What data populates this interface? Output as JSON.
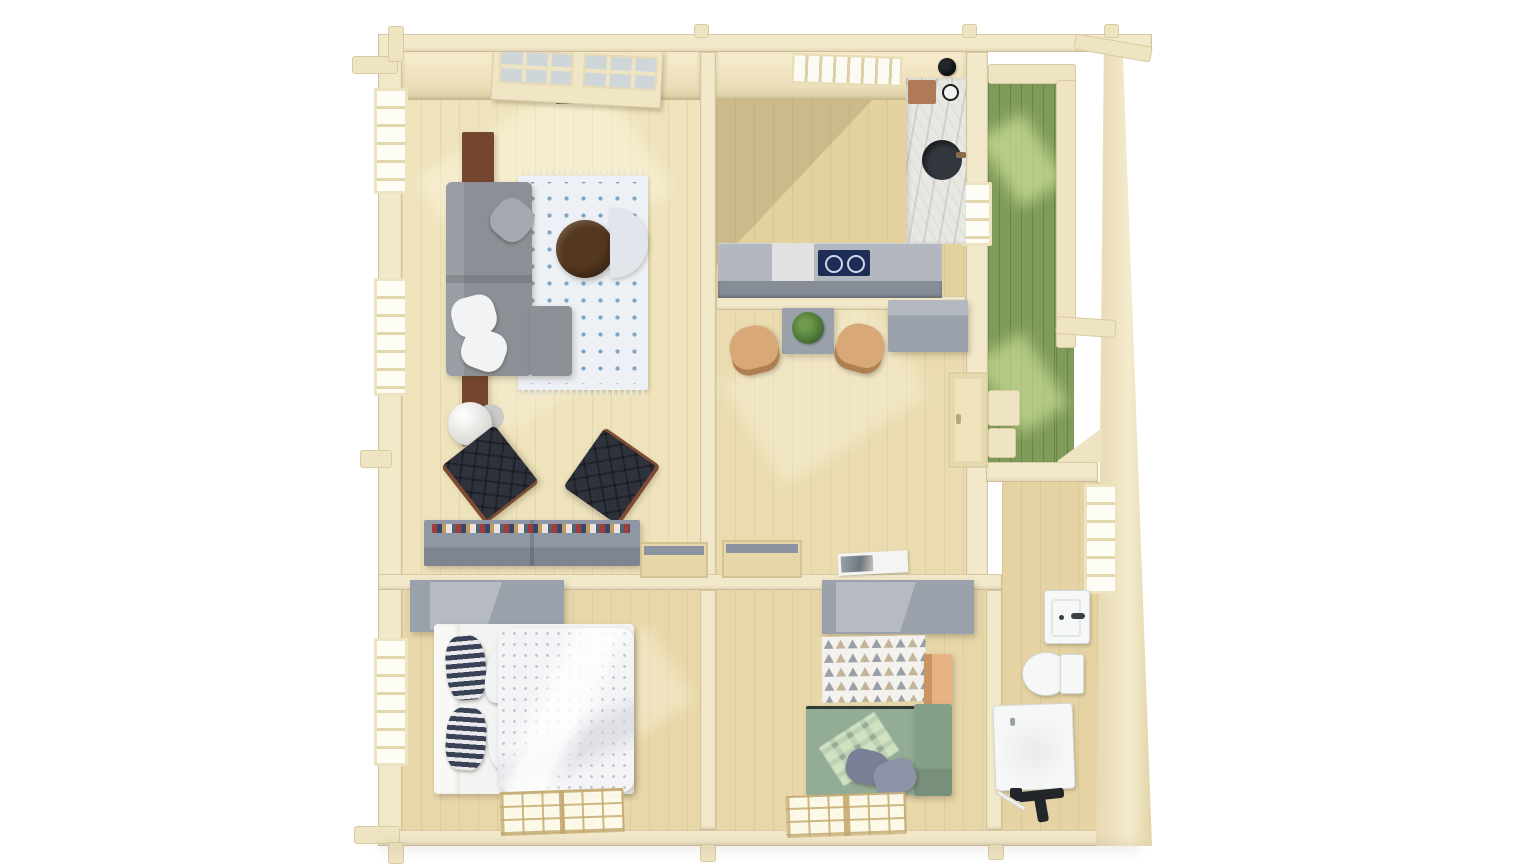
{
  "scene": {
    "description": "Top-down 3D architectural render of a single-storey log cabin with cut-away roof, five rooms and a green pergola terrace, on a white background",
    "background": "#ffffff"
  },
  "palette": {
    "wall": "#f2e8ca",
    "wallFace": "#efe4c2",
    "wallEdge": "#d9cba0",
    "floorLiving": "#eee3bb",
    "floorKitchen": "#e3d19e",
    "floorHall": "#eadcb0",
    "floorBed": "#e8d7a9",
    "floorBath": "#e5d3a3",
    "deckGreen": "#7f9b59",
    "deckGreenLight": "#bace8e",
    "deckFrame": "#eee2bc",
    "sofaGray": "#8c9096",
    "cushionGray": "#a4a8b0",
    "pillowWhite": "#f2f3f5",
    "rugWhite": "#edf0f4",
    "rugDotBlue": "#7fa7c4",
    "coffeeTableBrown": "#54371f",
    "consoleBrown": "#75462f",
    "armchairDark": "#2e323c",
    "armchairFrame": "#7d4b34",
    "benchGray": "#9097a4",
    "counterGray": "#868d97",
    "counterTop": "#b2b7c0",
    "marbleWhite": "#e9e7e2",
    "cooktopNavy": "#1e2d56",
    "sinkDark": "#33383f",
    "stoolTan": "#d8a877",
    "cabinetGray": "#9aa1ab",
    "cabinetGrayLight": "#b6bbc3",
    "plantGreen": "#4d7a39",
    "doorCream": "#efe3bd",
    "slateDark": "#5c6572",
    "magazineWhite": "#f4f4f2",
    "bedWhite": "#f3f3f1",
    "duvetWhite": "#f4f4f6",
    "pillowNavy": "#394257",
    "sageSofa": "#92ac96",
    "sageSofaDark": "#85a089",
    "pillowSlate": "#787f96",
    "orangeCabinet": "#e9b283",
    "rugTriBase": "#f4f2ee",
    "rugTriGray": "#999fa7",
    "rugTriTan": "#c3b499",
    "porcelain": "#f6f7f7",
    "drillBlack": "#22252a"
  },
  "rooms": [
    {
      "id": "living-room",
      "label": "living room",
      "furniture": [
        "gray corner sofa with cushions",
        "white rug with blue dots",
        "round dark-wood coffee table",
        "light tub chair",
        "white globe floor lamp",
        "tall brown cabinet",
        "brown console",
        "two dark tufted lounge chairs",
        "low gray sideboard with books",
        "french double door",
        "two left-wall windows"
      ]
    },
    {
      "id": "kitchen",
      "label": "kitchen",
      "furniture": [
        "gray counter with navy cooktop",
        "white marble worktop column",
        "round dark sink",
        "cutting board",
        "black kettle",
        "roof vent grille"
      ]
    },
    {
      "id": "dining-hall",
      "label": "dining hall",
      "furniture": [
        "gray dining table",
        "potted green plant",
        "two tan chairs",
        "gray cabinet",
        "door to terrace with steps",
        "magazine on floor"
      ]
    },
    {
      "id": "terrace",
      "label": "terrace",
      "furniture": [
        "green plank decking",
        "pergola beams and posts",
        "corner brace"
      ]
    },
    {
      "id": "bedroom-1",
      "label": "bedroom 1",
      "furniture": [
        "gray wardrobe",
        "double bed",
        "navy striped pillows",
        "white pillows",
        "dotted white duvet",
        "left-wall window",
        "sunlight window patch on floor"
      ]
    },
    {
      "id": "bedroom-2",
      "label": "bedroom 2",
      "furniture": [
        "gray wardrobe",
        "triangle-pattern rug",
        "orange cabinet",
        "sage green daybed sofa",
        "two gray pillows",
        "sunlight window patch on floor"
      ]
    },
    {
      "id": "bathroom",
      "label": "bathroom",
      "furniture": [
        "wall window",
        "white washbasin",
        "toilet",
        "square shower tray",
        "black power drill",
        "pencil"
      ]
    }
  ]
}
